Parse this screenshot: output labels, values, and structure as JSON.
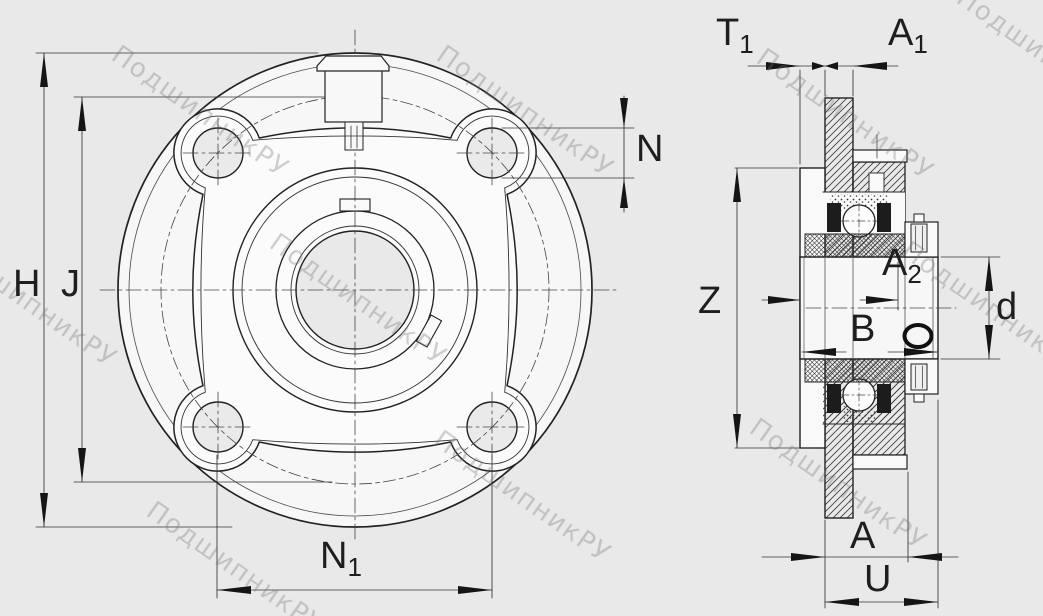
{
  "page": {
    "background": "#e9e9e9",
    "line_color": "#2b2b2b",
    "dim_color": "#333333",
    "arrow_color": "#151515",
    "white_fill": "#f9f9f9"
  },
  "watermark": {
    "text": "ПодшипникРУ"
  },
  "drawing": {
    "type": "bearing-unit-technical-drawing",
    "views": [
      "front-view-round-flange-cartridge-unit",
      "side-section-view"
    ]
  },
  "dimension_labels": {
    "H": {
      "main": "H",
      "sub": ""
    },
    "J": {
      "main": "J",
      "sub": ""
    },
    "N": {
      "main": "N",
      "sub": ""
    },
    "N1": {
      "main": "N",
      "sub": "1"
    },
    "T1": {
      "main": "T",
      "sub": "1"
    },
    "A1": {
      "main": "A",
      "sub": "1"
    },
    "A2": {
      "main": "A",
      "sub": "2"
    },
    "Z": {
      "main": "Z",
      "sub": ""
    },
    "d": {
      "main": "d",
      "sub": ""
    },
    "B": {
      "main": "B",
      "sub": ""
    },
    "A": {
      "main": "A",
      "sub": ""
    },
    "U": {
      "main": "U",
      "sub": ""
    }
  }
}
